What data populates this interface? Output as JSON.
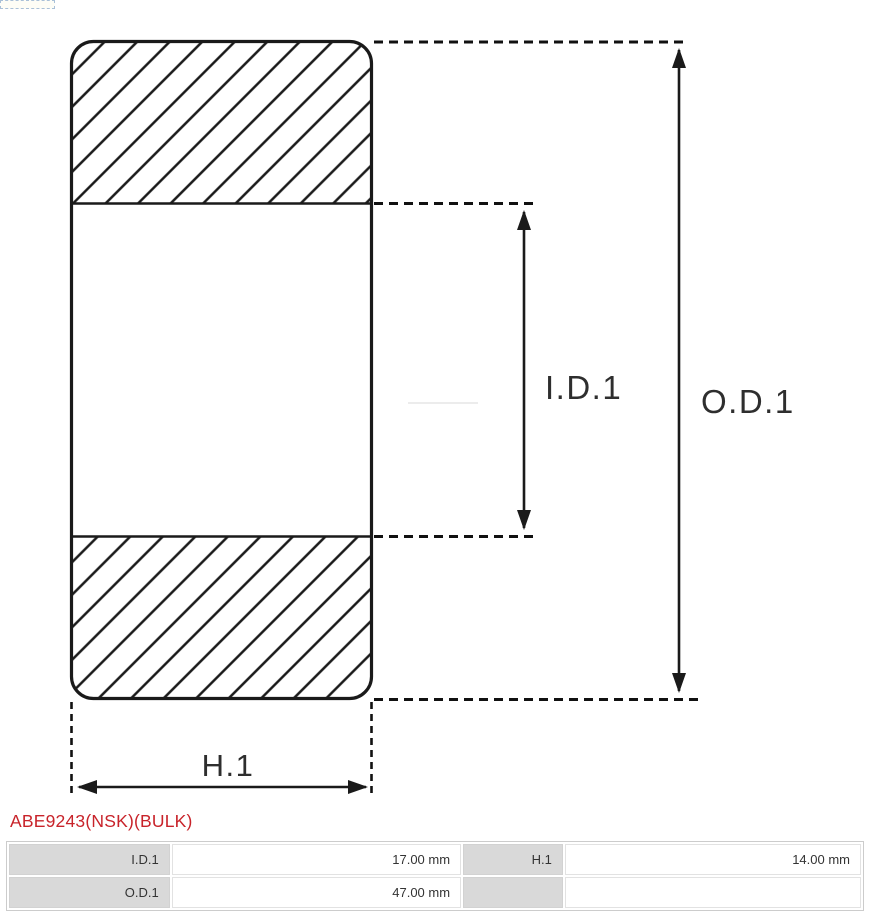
{
  "colors": {
    "accent": "#c8232a",
    "line": "#1a1a1a",
    "table_label_bg": "#d9d9d9",
    "table_border": "#cccccc",
    "cell_text": "#333333"
  },
  "part": {
    "number": "ABE9243(NSK)(BULK)"
  },
  "diagram": {
    "type": "bearing-cross-section",
    "labels": {
      "inner_diameter": "I.D.1",
      "outer_diameter": "O.D.1",
      "height": "H.1"
    }
  },
  "spec_table": {
    "rows": [
      {
        "label1": "I.D.1",
        "value1": "17.00 mm",
        "label2": "H.1",
        "value2": "14.00 mm"
      },
      {
        "label1": "O.D.1",
        "value1": "47.00 mm",
        "label2": "",
        "value2": ""
      }
    ]
  }
}
